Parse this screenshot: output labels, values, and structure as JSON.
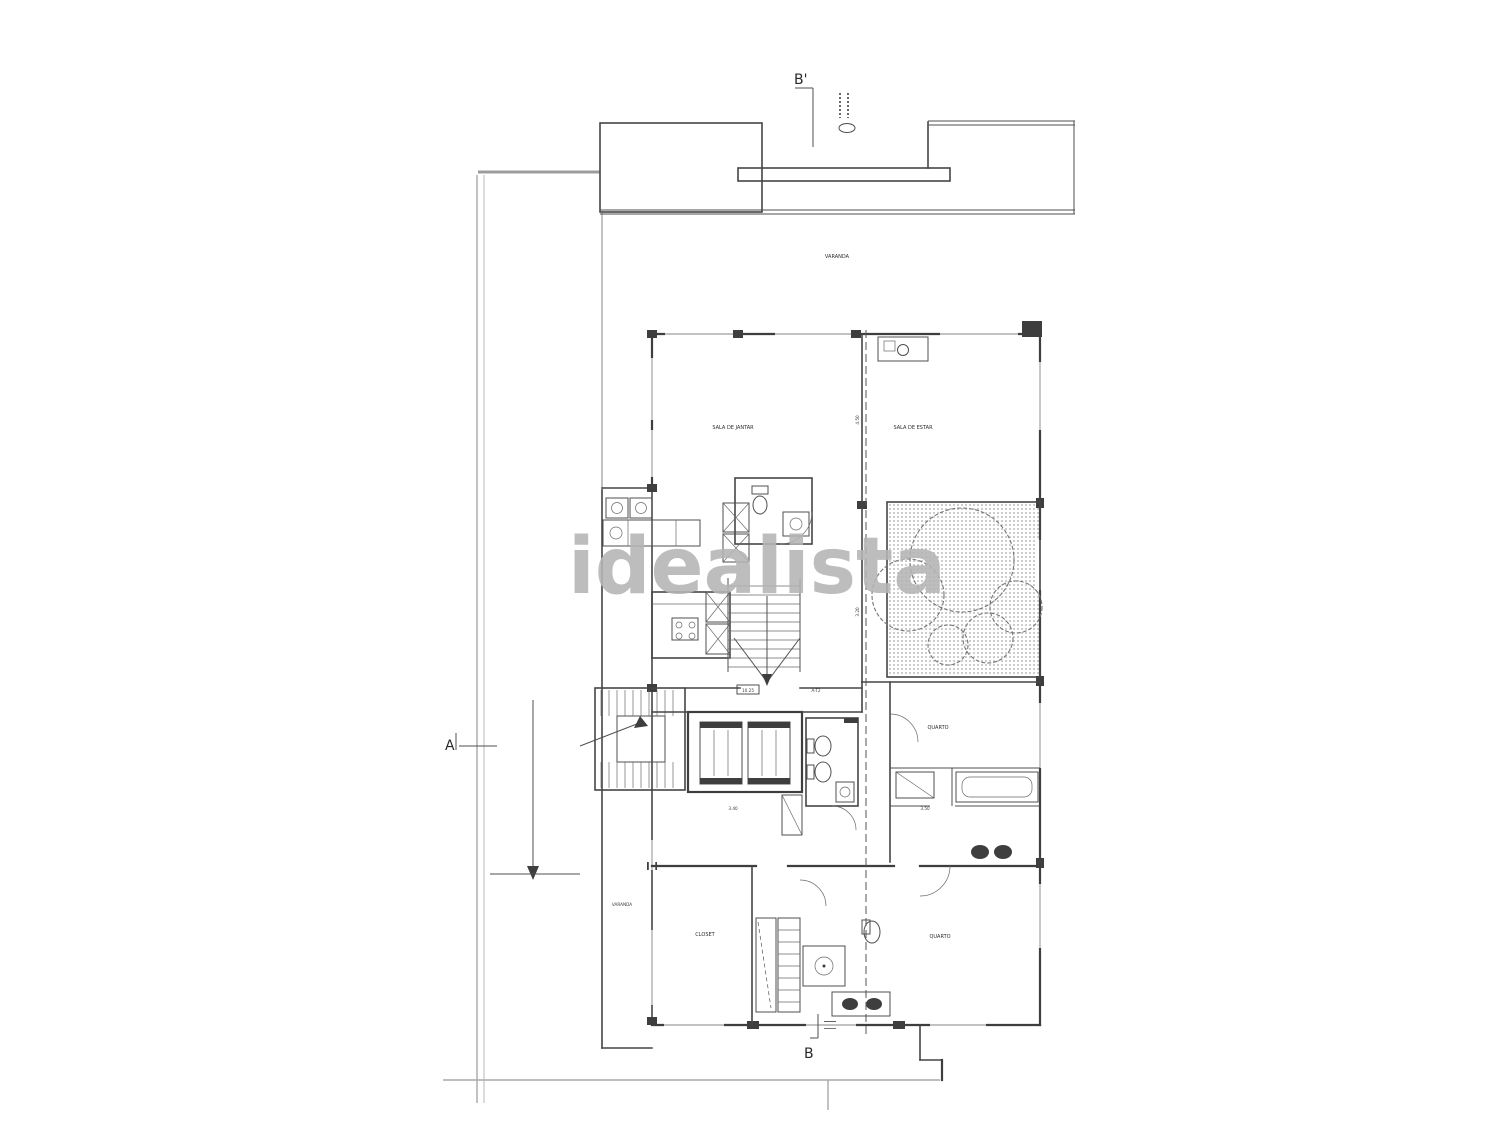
{
  "watermark": {
    "text": "idealista"
  },
  "markers": {
    "section_top": "B'",
    "section_bottom": "B",
    "section_left": "A"
  },
  "rooms": {
    "terrace_top": "VARANDA",
    "dining": "SALA DE JANTAR",
    "living": "SALA DE ESTAR",
    "bedroom_right": "QUARTO",
    "bedroom_bottom": "QUARTO",
    "closet_bottom": "CLOSET",
    "terrace_side": "VARANDA"
  },
  "dims": {
    "lobby_area": "10.25",
    "unit": "A-T2",
    "room_left": "3.40",
    "closet_right": "3.50",
    "section_a": "4.50",
    "section_b": "3.20"
  },
  "colors": {
    "wall": "#3e3e3e",
    "site_line": "#a9a9a9",
    "watermark_gray": "#b5b5b5"
  }
}
